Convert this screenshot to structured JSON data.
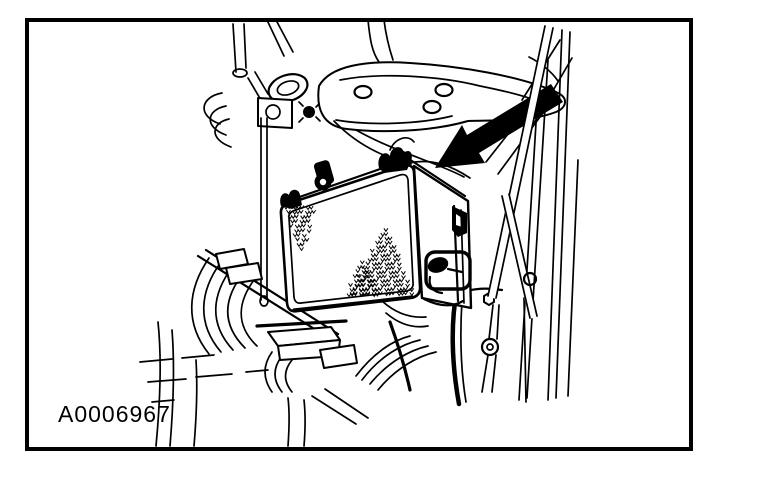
{
  "figure": {
    "label": "A0006967",
    "alt": "Engine compartment line illustration with a solid black callout arrow pointing to the powertrain control module",
    "background_color": "#ffffff",
    "line_color": "#000000",
    "arrow_color": "#000000"
  }
}
